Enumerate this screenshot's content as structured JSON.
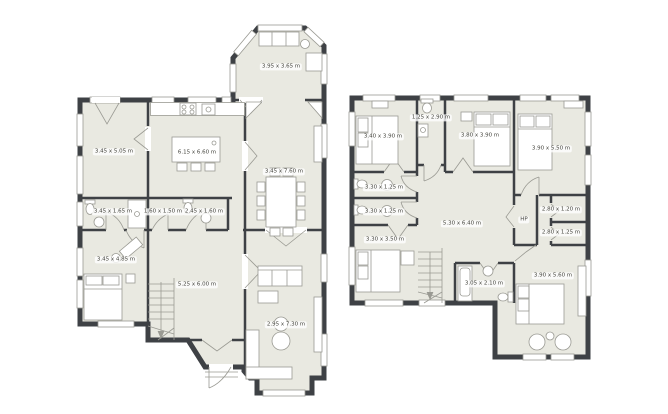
{
  "canvas": {
    "width": 668,
    "height": 414,
    "background": "#ffffff"
  },
  "colors": {
    "wall": "#3e4145",
    "floor": "#e9e9e1",
    "furniture_stroke": "#9a9a93",
    "window_fill": "#ffffff",
    "label_text": "#46463f"
  },
  "ground_floor": {
    "name": "ground floor plan",
    "rooms": [
      {
        "key": "conservatory",
        "label": "3.95 x 3.65 m"
      },
      {
        "key": "sitting-room",
        "label": "3.45 x 5.05 m"
      },
      {
        "key": "kitchen",
        "label": "6.15 x 6.60 m"
      },
      {
        "key": "dining-room",
        "label": "3.45 x 7.60 m"
      },
      {
        "key": "bathroom",
        "label": "3.45 x 1.65 m"
      },
      {
        "key": "closet",
        "label": "1.60 x 1.50 m"
      },
      {
        "key": "wc",
        "label": "2.45 x 1.60 m"
      },
      {
        "key": "bedroom",
        "label": "3.45 x 4.85 m"
      },
      {
        "key": "hall",
        "label": "5.25 x 6.00 m"
      },
      {
        "key": "living-room",
        "label": "2.95 x 7.30 m"
      }
    ]
  },
  "upper_floor": {
    "name": "upper floor plan",
    "rooms": [
      {
        "key": "bedroom-1",
        "label": "3.40 x 3.90 m"
      },
      {
        "key": "bathroom-1",
        "label": "1.25 x 2.90 m"
      },
      {
        "key": "bedroom-2",
        "label": "3.80 x 3.90 m"
      },
      {
        "key": "bedroom-3",
        "label": "3.90 x 5.50 m"
      },
      {
        "key": "bathroom-2",
        "label": "3.30 x 1.25 m"
      },
      {
        "key": "bathroom-3",
        "label": "3.30 x 1.25 m"
      },
      {
        "key": "landing",
        "label": "5.30 x 6.40 m"
      },
      {
        "key": "hp-closet",
        "label": "HP"
      },
      {
        "key": "bathroom-4",
        "label": "2.80 x 1.20 m"
      },
      {
        "key": "bathroom-5",
        "label": "2.80 x 1.25 m"
      },
      {
        "key": "bedroom-4",
        "label": "3.30 x 3.50 m"
      },
      {
        "key": "bathroom-6",
        "label": "3.05 x 2.10 m"
      },
      {
        "key": "bedroom-5",
        "label": "3.90 x 5.60 m"
      }
    ]
  }
}
